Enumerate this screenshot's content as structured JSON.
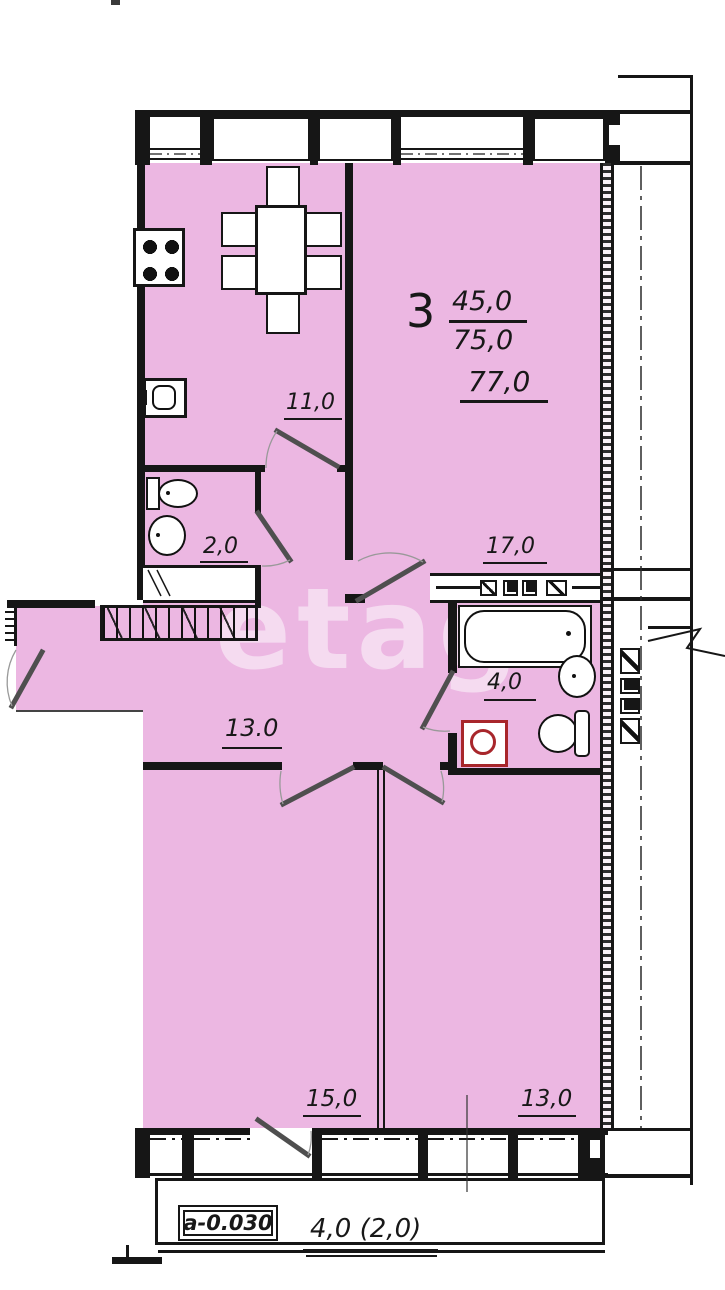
{
  "watermark": "etagi",
  "summary": {
    "rooms": "3",
    "living_area": "45,0",
    "total_area": "75,0",
    "overall_area": "77,0"
  },
  "rooms": {
    "kitchen": "11,0",
    "toilet": "2,0",
    "living": "17,0",
    "bathroom": "4,0",
    "hallway": "13.0",
    "bedroom_left": "15,0",
    "bedroom_right": "13,0"
  },
  "balcony": {
    "level_mark": "а-0.030",
    "area": "4,0 (2,0)"
  },
  "colors": {
    "room_fill": "#ecb7e2",
    "wall": "#161616",
    "door_leaf": "#4f4f4f",
    "appliance_red": "#a8262b"
  }
}
